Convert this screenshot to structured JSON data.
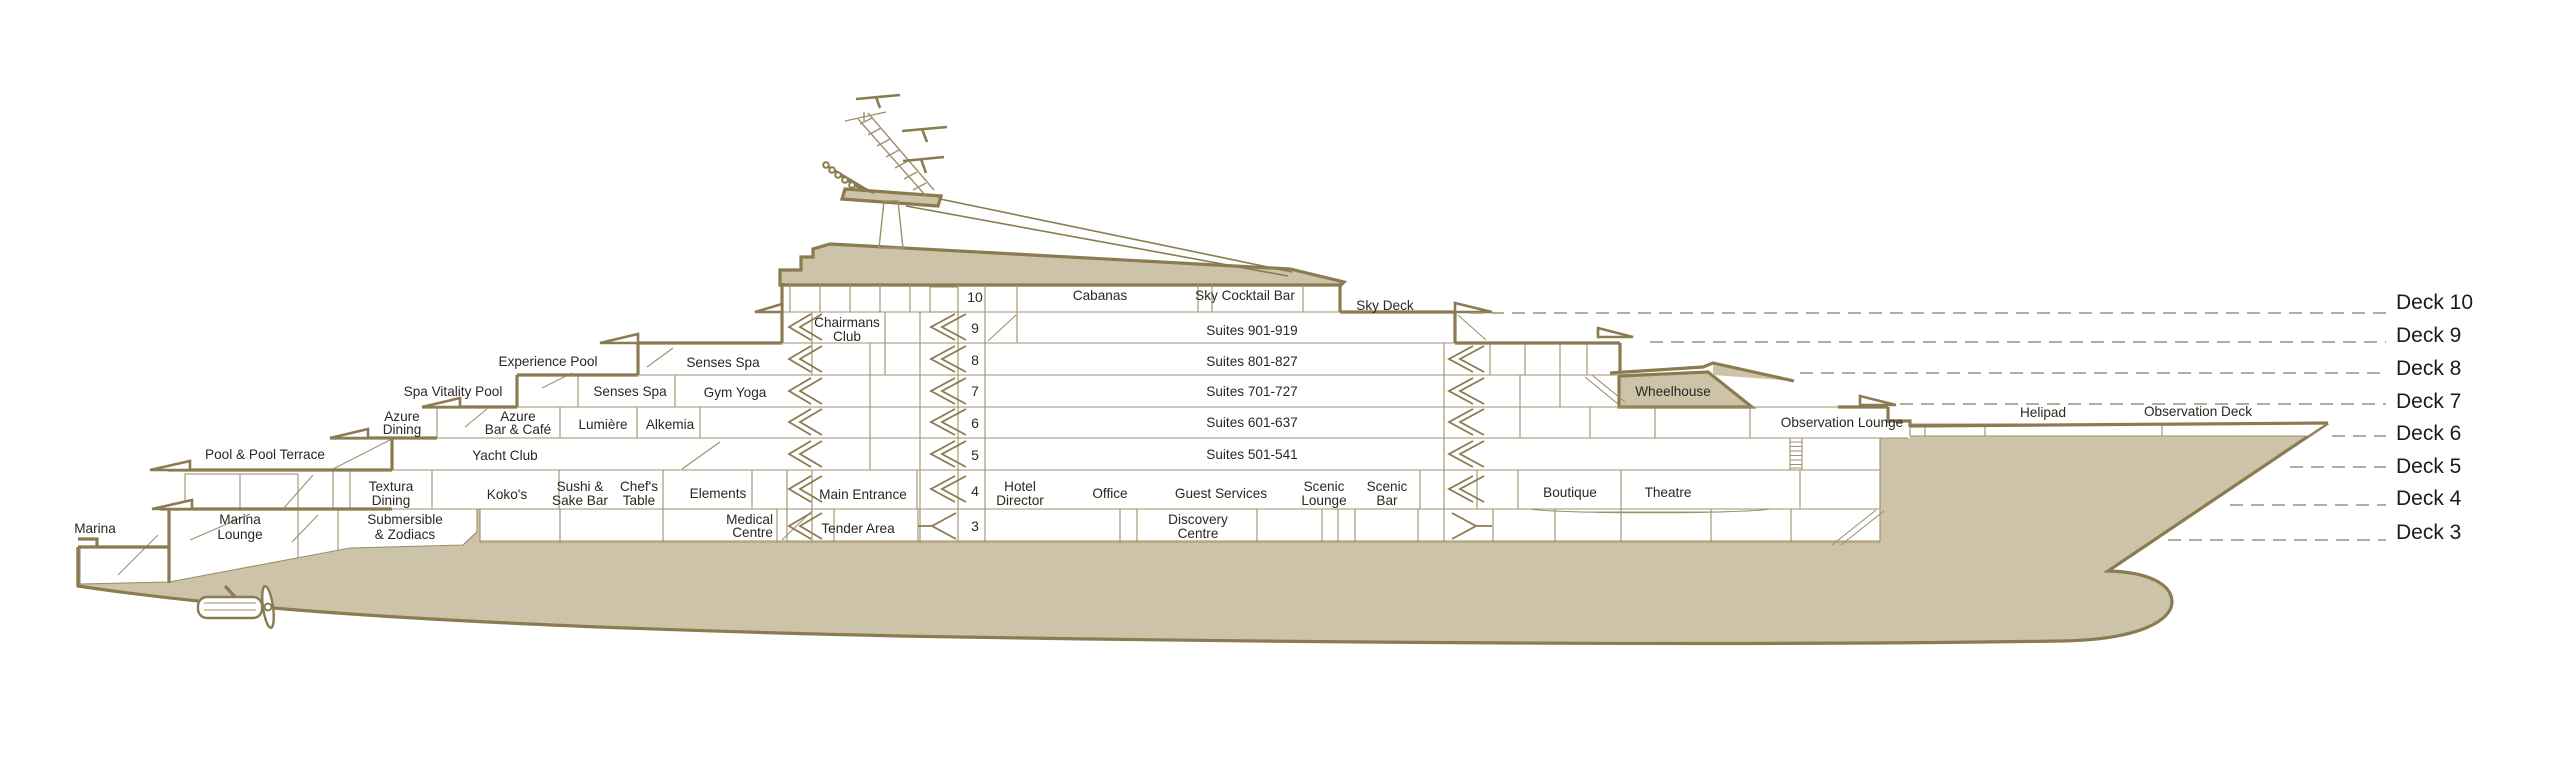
{
  "diagram": {
    "title": "Ship deck cross-section diagram",
    "colors": {
      "outline": "#8a7b50",
      "thin_line": "#9c916c",
      "hull_fill": "#cdc3a8",
      "text": "#2b2723",
      "dash_line": "#9a9078",
      "background": "#ffffff"
    }
  },
  "deck_scale": [
    "Deck 10",
    "Deck 9",
    "Deck 8",
    "Deck 7",
    "Deck 6",
    "Deck 5",
    "Deck 4",
    "Deck 3"
  ],
  "deck_numbers": [
    "10",
    "9",
    "8",
    "7",
    "6",
    "5",
    "4",
    "3"
  ],
  "rooms": {
    "sky_deck": "Sky Deck",
    "cabanas": "Cabanas",
    "sky_cocktail_bar": "Sky Cocktail Bar",
    "chairmans_club": {
      "l1": "Chairmans",
      "l2": "Club"
    },
    "suites_900": "Suites 901-919",
    "suites_800": "Suites 801-827",
    "suites_700": "Suites 701-727",
    "suites_600": "Suites 601-637",
    "suites_500": "Suites 501-541",
    "experience_pool": "Experience Pool",
    "senses_spa_deck8": "Senses Spa",
    "spa_vitality_pool": "Spa Vitality Pool",
    "senses_spa_deck7": "Senses Spa",
    "gym_yoga": "Gym Yoga",
    "azure_dining": {
      "l1": "Azure",
      "l2": "Dining"
    },
    "azure_bar_cafe": {
      "l1": "Azure",
      "l2": "Bar & Café"
    },
    "lumiere": "Lumière",
    "alkemia": "Alkemia",
    "pool_pool_terrace": "Pool & Pool Terrace",
    "yacht_club": "Yacht Club",
    "textura_dining": {
      "l1": "Textura",
      "l2": "Dining"
    },
    "kokos": "Koko's",
    "sushi_sake_bar": {
      "l1": "Sushi &",
      "l2": "Sake Bar"
    },
    "chefs_table": {
      "l1": "Chef's",
      "l2": "Table"
    },
    "elements": "Elements",
    "main_entrance": "Main Entrance",
    "hotel_director": {
      "l1": "Hotel",
      "l2": "Director"
    },
    "office": "Office",
    "guest_services": "Guest Services",
    "scenic_lounge": {
      "l1": "Scenic",
      "l2": "Lounge"
    },
    "scenic_bar": {
      "l1": "Scenic",
      "l2": "Bar"
    },
    "marina": "Marina",
    "marina_lounge": {
      "l1": "Marina",
      "l2": "Lounge"
    },
    "submersible_zodiacs": {
      "l1": "Submersible",
      "l2": "& Zodiacs"
    },
    "medical_centre": {
      "l1": "Medical",
      "l2": "Centre"
    },
    "tender_area": "Tender Area",
    "discovery_centre": {
      "l1": "Discovery",
      "l2": "Centre"
    },
    "wheelhouse": "Wheelhouse",
    "observation_lounge": "Observation Lounge",
    "boutique": "Boutique",
    "theatre": "Theatre",
    "helipad": "Helipad",
    "observation_deck": "Observation Deck"
  }
}
